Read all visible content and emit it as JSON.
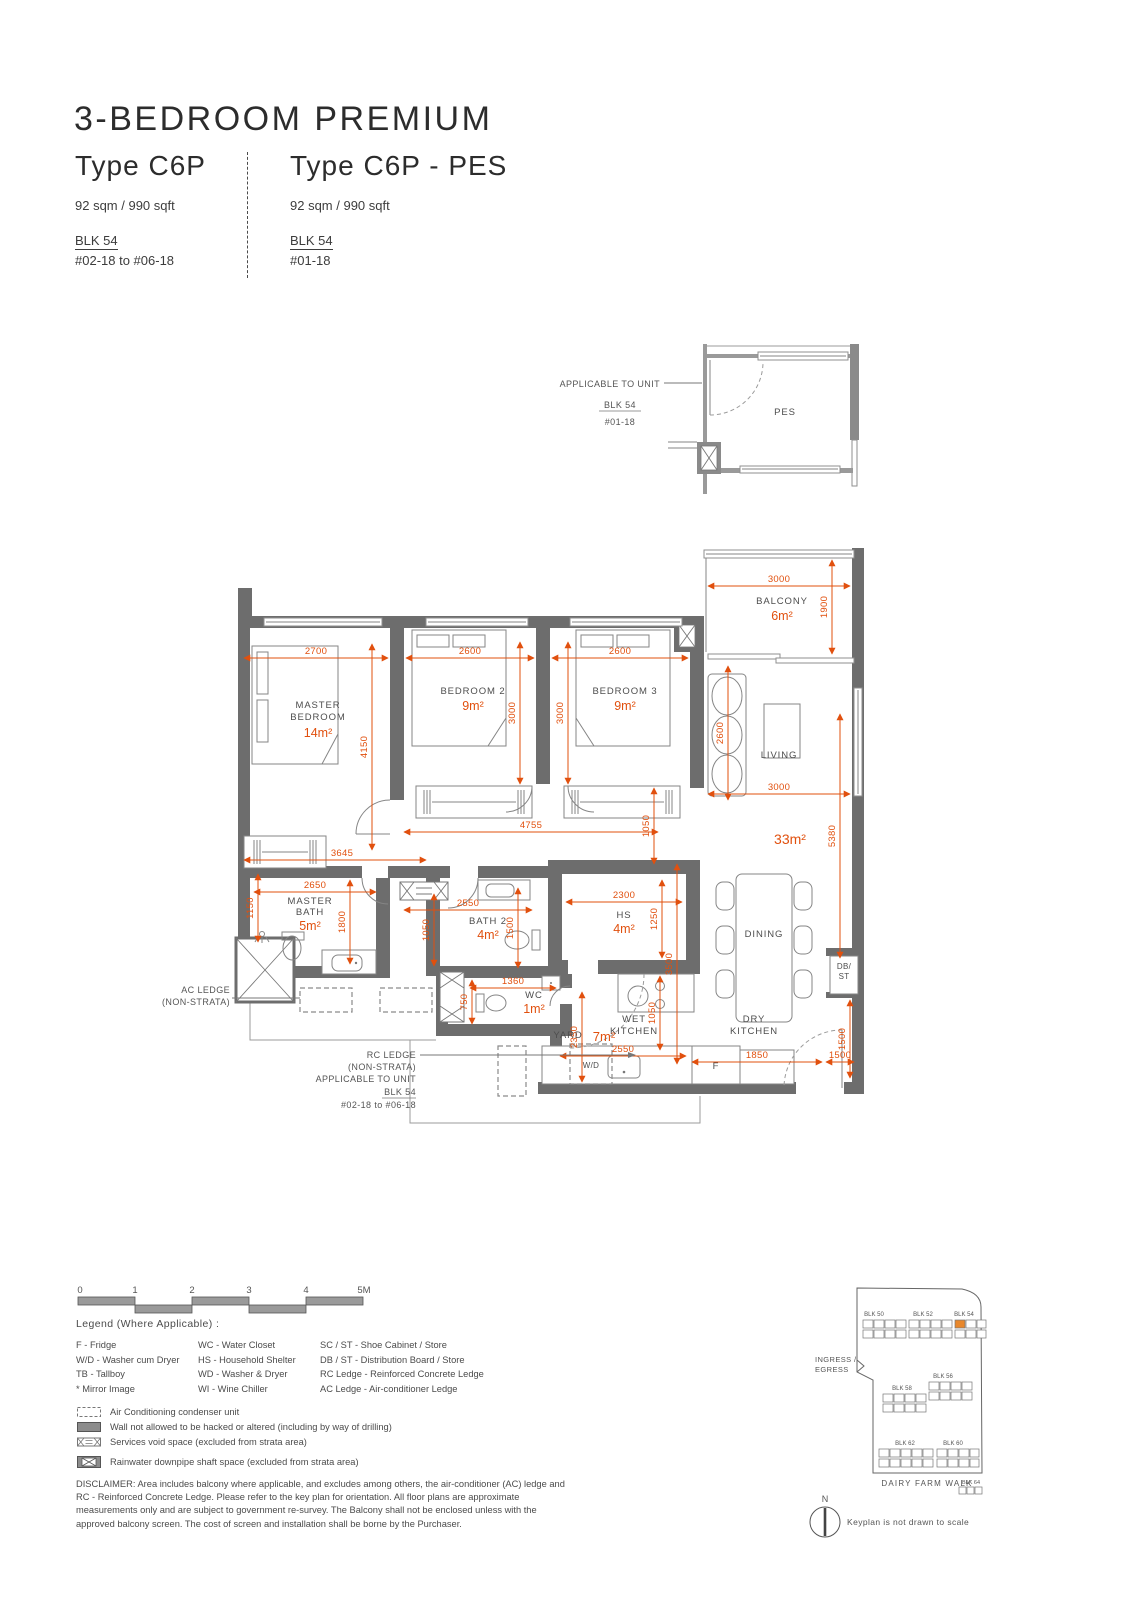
{
  "header": {
    "title": "3-BEDROOM PREMIUM",
    "left": {
      "type": "Type C6P",
      "area": "92 sqm / 990 sqft",
      "blk": "BLK 54",
      "units": "#02-18 to #06-18"
    },
    "right": {
      "type": "Type C6P - PES",
      "area": "92 sqm / 990 sqft",
      "blk": "BLK 54",
      "units": "#01-18"
    }
  },
  "pes_inset": {
    "callout": "APPLICABLE TO UNIT",
    "blk": "BLK 54",
    "unit": "#01-18",
    "room": "PES"
  },
  "plan": {
    "rooms": {
      "master_bedroom": {
        "l1": "MASTER",
        "l2": "BEDROOM",
        "area": "14m²"
      },
      "bedroom2": {
        "l1": "BEDROOM 2",
        "area": "9m²"
      },
      "bedroom3": {
        "l1": "BEDROOM 3",
        "area": "9m²"
      },
      "balcony": {
        "l1": "BALCONY",
        "area": "6m²"
      },
      "living": {
        "l1": "LIVING",
        "area": "33m²"
      },
      "master_bath": {
        "l1": "MASTER",
        "l2": "BATH",
        "area": "5m²"
      },
      "bath2": {
        "l1": "BATH 2",
        "area": "4m²"
      },
      "hs": {
        "l1": "HS",
        "area": "4m²"
      },
      "wc": {
        "l1": "WC",
        "area": "1m²"
      },
      "dining": {
        "l1": "DINING"
      },
      "wet_kitchen": {
        "l1": "WET",
        "l2": "KITCHEN"
      },
      "dry_kitchen": {
        "l1": "DRY",
        "l2": "KITCHEN"
      },
      "yard": {
        "l1": "YARD",
        "area": "7m²"
      },
      "wd": {
        "l1": "W/D"
      },
      "fridge": {
        "l1": "F"
      },
      "dbst": {
        "l1": "DB/",
        "l2": "ST"
      }
    },
    "dims": {
      "balcony_w": "3000",
      "balcony_h": "1900",
      "mbr_w": "2700",
      "mbr_h": "4150",
      "mbr_wardrobe": "3645",
      "br2_w": "2600",
      "br2_h": "3000",
      "br3_w": "2600",
      "br3_h": "3000",
      "living_w": "3000",
      "living_h": "5380",
      "sofa": "2600",
      "corridor_w": "4755",
      "corridor_h": "1050",
      "mbath_w": "2650",
      "mbath_l": "1150",
      "mbath_h": "1800",
      "bath2_w": "2550",
      "bath2_l": "1050",
      "bath2_r": "1500",
      "hs_w": "2300",
      "hs_h": "1250",
      "wc_w": "1360",
      "wc_h": "750",
      "dining_h": "3500",
      "yard_h": "2350",
      "yard_w": "2550",
      "wetk_h": "1050",
      "dryk_w": "1850",
      "entry_w": "1500",
      "entry_h": "1500"
    },
    "callouts": {
      "ac1": "AC LEDGE",
      "ac2": "(NON-STRATA)",
      "rc1": "RC LEDGE",
      "rc2": "(NON-STRATA)",
      "rc3": "APPLICABLE TO UNIT",
      "rc4": "BLK 54",
      "rc5": "#02-18 to #06-18"
    }
  },
  "scalebar": {
    "l0": "0",
    "l1": "1",
    "l2": "2",
    "l3": "3",
    "l4": "4",
    "l5": "5M"
  },
  "legend": {
    "title": "Legend (Where Applicable) :",
    "col1": [
      "F - Fridge",
      "W/D - Washer cum Dryer",
      "TB - Tallboy",
      "* Mirror Image"
    ],
    "col2": [
      "WC - Water Closet",
      "HS - Household Shelter",
      "WD - Washer & Dryer",
      "WI - Wine Chiller"
    ],
    "col3": [
      "SC / ST - Shoe Cabinet / Store",
      "DB / ST - Distribution Board / Store",
      "RC Ledge - Reinforced Concrete Ledge",
      "AC Ledge - Air-conditioner Ledge"
    ],
    "symbols": [
      "Air Conditioning condenser unit",
      "Wall not allowed to be hacked or altered (including by way of drilling)",
      "Services void space (excluded from strata area)",
      "Rainwater downpipe shaft space (excluded from strata area)"
    ]
  },
  "disclaimer": "DISCLAIMER: Area includes balcony where applicable, and excludes among others, the air-conditioner (AC) ledge and RC - Reinforced Concrete Ledge. Please refer to the key plan for orientation. All floor plans are approximate measurements only and are subject to government re-survey. The Balcony shall not be enclosed unless with the approved balcony screen. The cost of screen and installation shall be borne by the Purchaser.",
  "keyplan": {
    "blocks": [
      "BLK 50",
      "BLK 52",
      "BLK 54",
      "BLK 58",
      "BLK 56",
      "BLK 62",
      "BLK 60",
      "BLK 64"
    ],
    "ingress1": "INGRESS /",
    "ingress2": "EGRESS",
    "street": "DAIRY FARM WALK",
    "note": "Keyplan is not drawn to scale",
    "north": "N"
  },
  "colors": {
    "dimension": "#e1500e",
    "wall": "#6d6d6d",
    "highlight": "#e8872b"
  }
}
